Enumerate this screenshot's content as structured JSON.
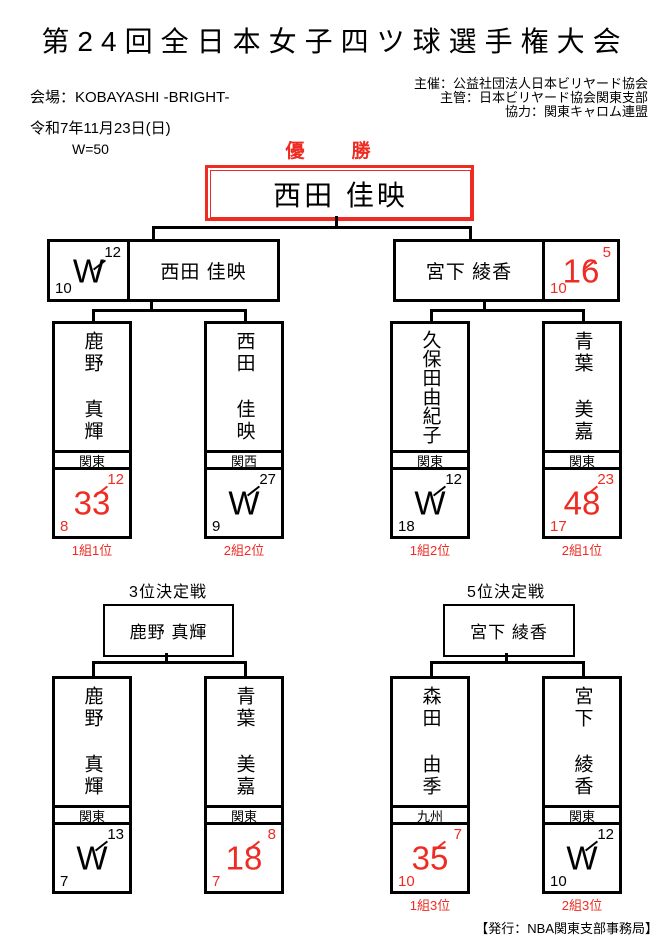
{
  "header": {
    "title": "第24回全日本女子四ツ球選手権大会",
    "venue": "会場：KOBAYASHI -BRIGHT-",
    "date": "令和7年11月23日(日)",
    "w_value": "W=50",
    "organizers": [
      "主催：公益社団法人日本ビリヤード協会",
      "主管：日本ビリヤード協会関東支部",
      "協力：関東キャロム連盟"
    ]
  },
  "colors": {
    "accent_red": "#ee2c23",
    "line_black": "#000000"
  },
  "final": {
    "label": "優　勝",
    "champion": "西田 佳映"
  },
  "semifinals": [
    {
      "name": "西田 佳映",
      "score": "W",
      "score_top": "12",
      "score_bottom": "10"
    },
    {
      "name": "宮下 綾香",
      "score": "16",
      "score_top": "5",
      "score_bottom": "10"
    }
  ],
  "quarterfinals": [
    {
      "name": "鹿野 真輝",
      "region": "関東",
      "score": "33",
      "score_top": "12",
      "score_bottom": "8",
      "rank": "1組1位"
    },
    {
      "name": "西田 佳映",
      "region": "関西",
      "score": "W",
      "score_top": "27",
      "score_bottom": "9",
      "rank": "2組2位"
    },
    {
      "name": "久保田由紀子",
      "region": "関東",
      "score": "W",
      "score_top": "12",
      "score_bottom": "18",
      "rank": "1組2位"
    },
    {
      "name": "青葉 美嘉",
      "region": "関東",
      "score": "48",
      "score_top": "23",
      "score_bottom": "17",
      "rank": "2組1位"
    }
  ],
  "third_place": {
    "title": "3位決定戦",
    "winner": "鹿野 真輝",
    "players": [
      {
        "name": "鹿野 真輝",
        "region": "関東",
        "score": "W",
        "score_top": "13",
        "score_bottom": "7"
      },
      {
        "name": "青葉 美嘉",
        "region": "関東",
        "score": "18",
        "score_top": "8",
        "score_bottom": "7"
      }
    ]
  },
  "fifth_place": {
    "title": "5位決定戦",
    "winner": "宮下 綾香",
    "players": [
      {
        "name": "森田 由季",
        "region": "九州",
        "score": "35",
        "score_top": "7",
        "score_bottom": "10",
        "rank": "1組3位"
      },
      {
        "name": "宮下 綾香",
        "region": "関東",
        "score": "W",
        "score_top": "12",
        "score_bottom": "10",
        "rank": "2組3位"
      }
    ]
  },
  "footer": {
    "publisher": "【発行：NBA関東支部事務局】"
  }
}
